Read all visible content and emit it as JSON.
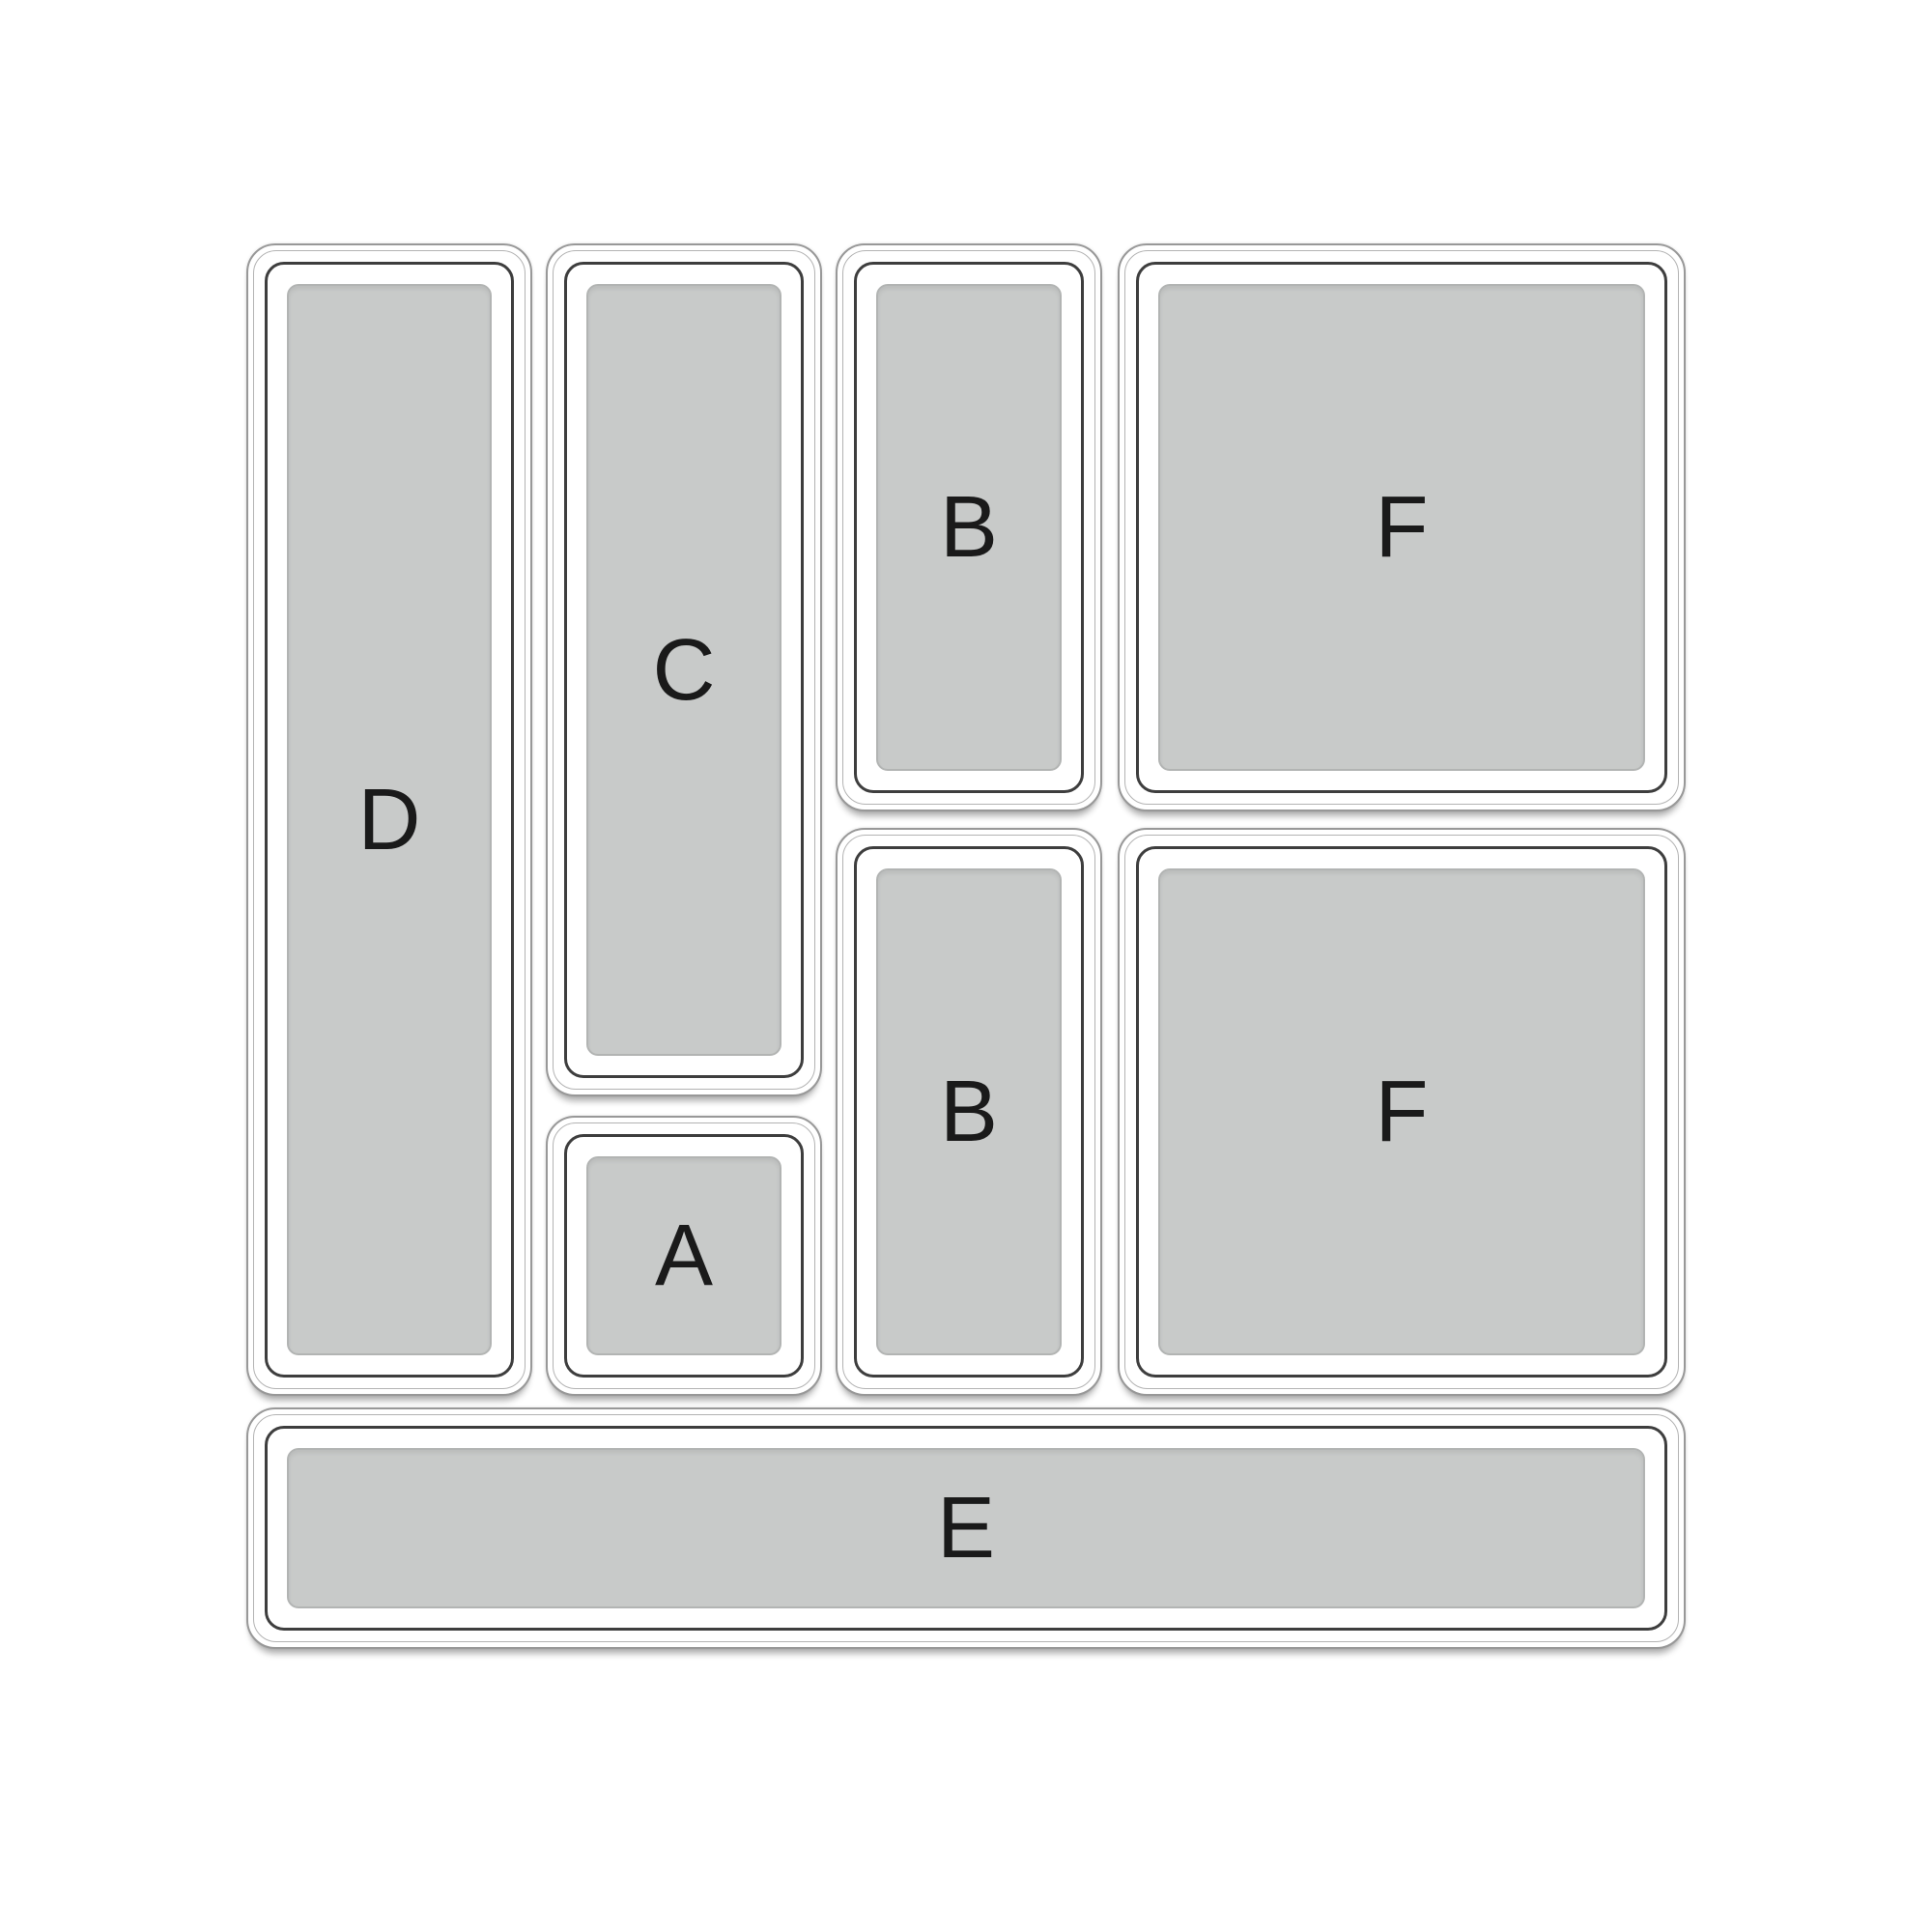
{
  "diagram": {
    "name": "drawer-organizer-layout",
    "background_color": "#ffffff",
    "tray_outline_color": "#989898",
    "tray_lip_color": "#b3b3b3",
    "tray_wall_color": "#3e3e3e",
    "tray_base_color": "#c8cac9",
    "label_color": "#1a1a1a"
  },
  "trays": [
    {
      "label": "D"
    },
    {
      "label": "C"
    },
    {
      "label": "A"
    },
    {
      "label": "B"
    },
    {
      "label": "B"
    },
    {
      "label": "F"
    },
    {
      "label": "F"
    },
    {
      "label": "E"
    }
  ]
}
